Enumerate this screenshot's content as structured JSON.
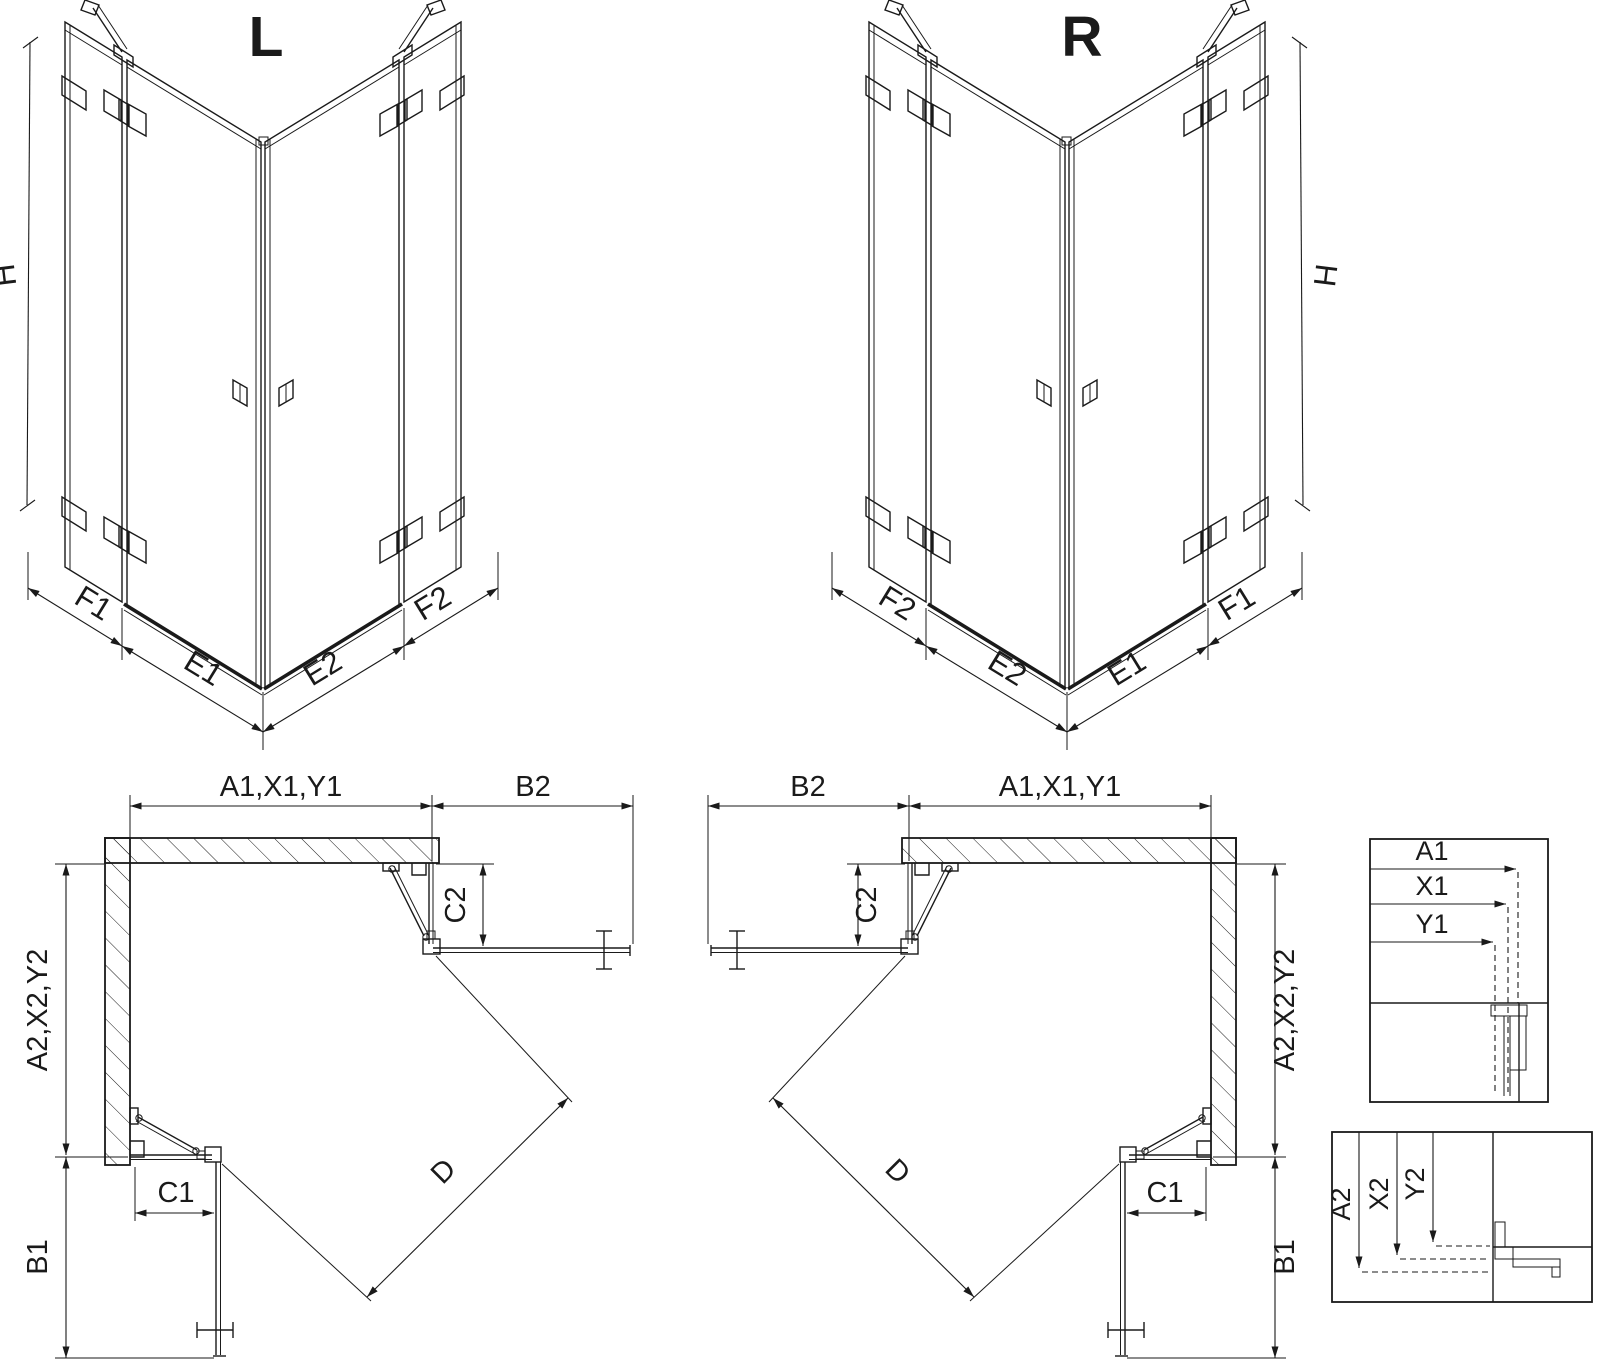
{
  "colors": {
    "line": "#1a1a1a",
    "background": "#ffffff"
  },
  "views": {
    "iso_left": {
      "title": "L",
      "height_dim": "H",
      "segments": {
        "outer_left": "F1",
        "door_left": "E1",
        "door_right": "E2",
        "outer_right": "F2"
      }
    },
    "iso_right": {
      "title": "R",
      "height_dim": "H",
      "segments": {
        "outer_left": "F2",
        "door_left": "E2",
        "door_right": "E1",
        "outer_right": "F1"
      }
    },
    "plan_left": {
      "top_width": "A1,X1,Y1",
      "top_door_width": "B2",
      "fixed_top": "C2",
      "depth": "A2,X2,Y2",
      "door_depth": "B1",
      "fixed_bottom": "C1",
      "diagonal": "D"
    },
    "plan_right": {
      "top_width": "A1,X1,Y1",
      "top_door_width": "B2",
      "fixed_top": "C2",
      "depth": "A2,X2,Y2",
      "door_depth": "B1",
      "fixed_bottom": "C1",
      "diagonal": "D"
    },
    "detail_widths": {
      "labels": [
        "A1",
        "X1",
        "Y1"
      ]
    },
    "detail_depths": {
      "labels": [
        "A2",
        "X2",
        "Y2"
      ]
    }
  }
}
